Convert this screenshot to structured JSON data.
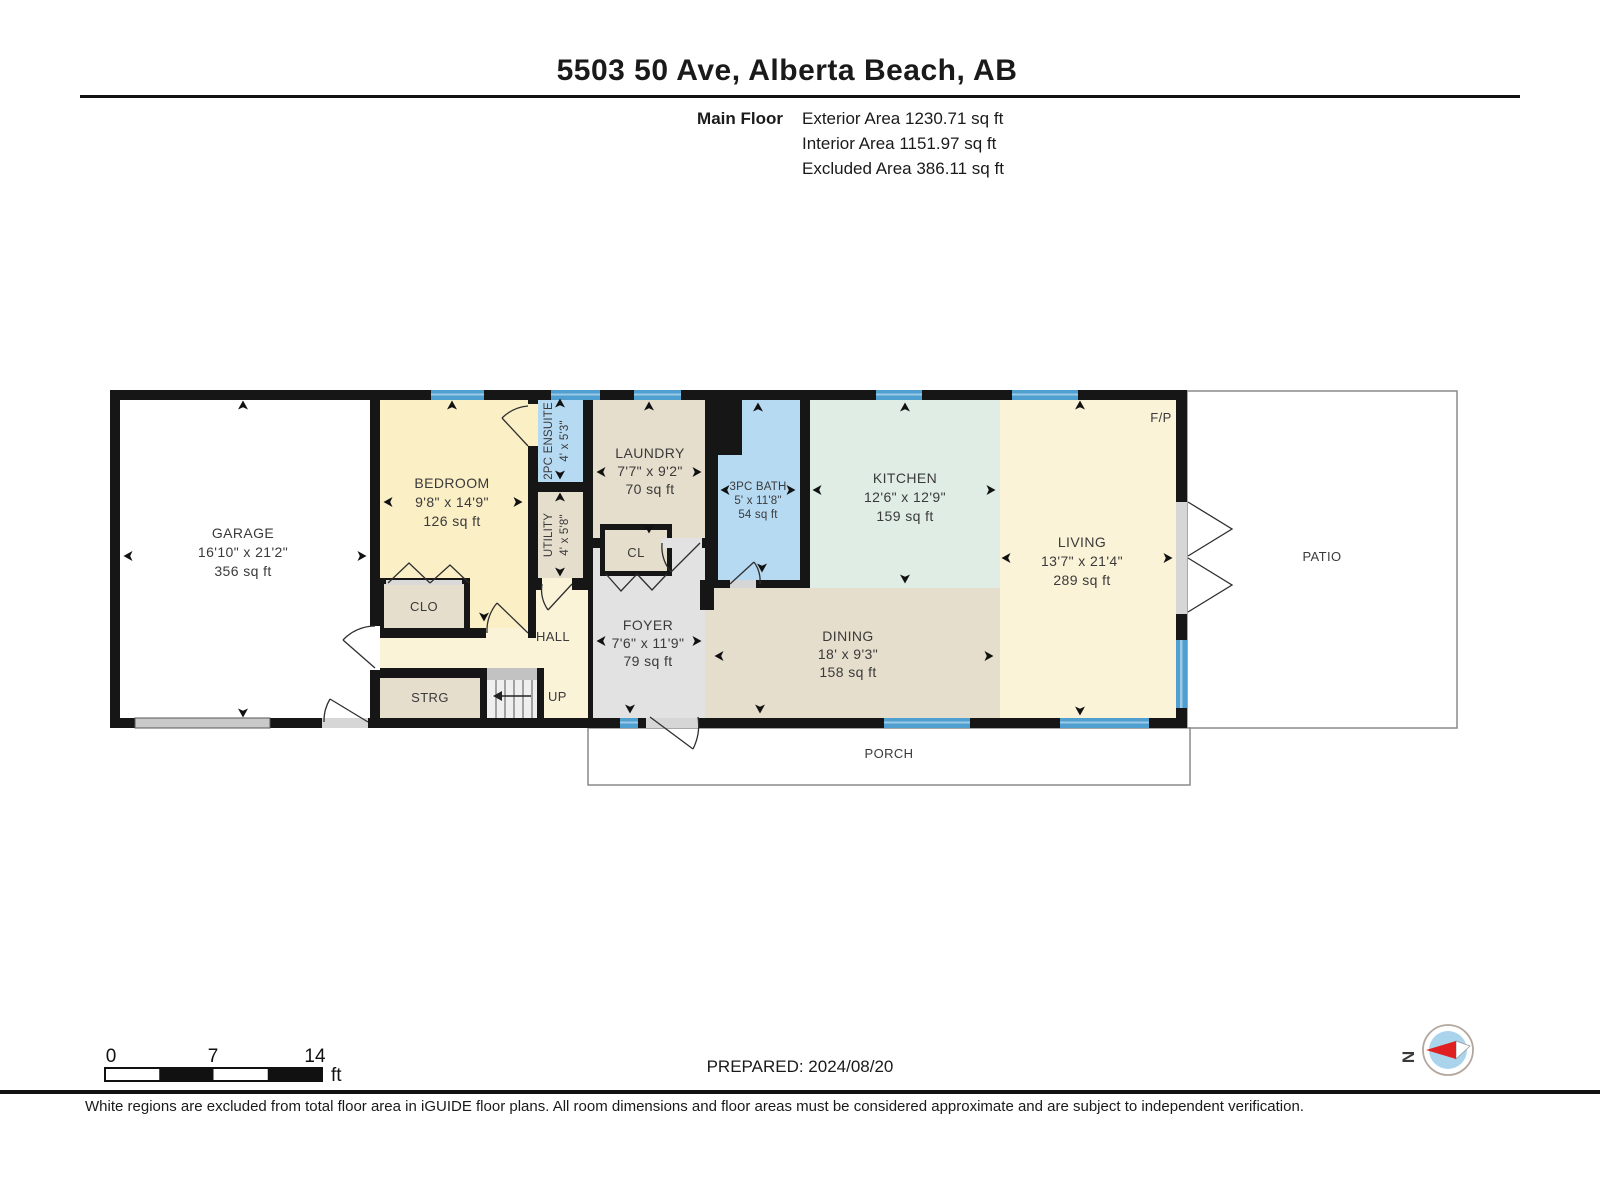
{
  "header": {
    "title": "5503 50 Ave, Alberta Beach, AB",
    "floor_label": "Main Floor",
    "area_lines": [
      "Exterior Area 1230.71 sq ft",
      "Interior Area 1151.97 sq ft",
      "Excluded Area 386.11 sq ft"
    ]
  },
  "rooms": {
    "garage": {
      "name": "GARAGE",
      "dims": "16'10\" x 21'2\"",
      "area": "356 sq ft"
    },
    "bedroom": {
      "name": "BEDROOM",
      "dims": "9'8\" x 14'9\"",
      "area": "126 sq ft"
    },
    "ensuite": {
      "name": "2PC ENSUITE",
      "dims": "4' x 5'3\""
    },
    "utility": {
      "name": "UTILITY",
      "dims": "4' x 5'8\""
    },
    "laundry": {
      "name": "LAUNDRY",
      "dims": "7'7\" x 9'2\"",
      "area": "70 sq ft"
    },
    "bath": {
      "name": "3PC BATH",
      "dims": "5' x 11'8\"",
      "area": "54 sq ft"
    },
    "kitchen": {
      "name": "KITCHEN",
      "dims": "12'6\" x 12'9\"",
      "area": "159 sq ft"
    },
    "living": {
      "name": "LIVING",
      "dims": "13'7\" x 21'4\"",
      "area": "289 sq ft"
    },
    "foyer": {
      "name": "FOYER",
      "dims": "7'6\" x 11'9\"",
      "area": "79 sq ft"
    },
    "dining": {
      "name": "DINING",
      "dims": "18' x 9'3\"",
      "area": "158 sq ft"
    }
  },
  "labels": {
    "clo": "CLO",
    "cl": "CL",
    "hall": "HALL",
    "strg": "STRG",
    "up": "UP",
    "fireplace": "F/P",
    "patio": "PATIO",
    "porch": "PORCH"
  },
  "scale_bar": {
    "start": "0",
    "mid": "7",
    "end": "14",
    "unit": "ft"
  },
  "compass": {
    "north": "N"
  },
  "footer": {
    "prepared": "PREPARED: 2024/08/20",
    "disclaimer": "White regions are excluded from total floor area in iGUIDE floor plans. All room dimensions and floor areas must be considered approximate and are subject to independent verification."
  },
  "colors": {
    "wall": "#161616",
    "room_cream": "#FBF3D8",
    "room_yellow": "#FBEFC6",
    "room_tan": "#E6DECD",
    "room_mint": "#DFEDE4",
    "room_gray": "#E2E2E2",
    "room_blue": "#B7DAF3",
    "window_blue": "#4FA0D0",
    "window_stripe": "#9CCAE6",
    "door_threshold": "#D6D6D6",
    "excluded_white": "#FFFFFF"
  }
}
